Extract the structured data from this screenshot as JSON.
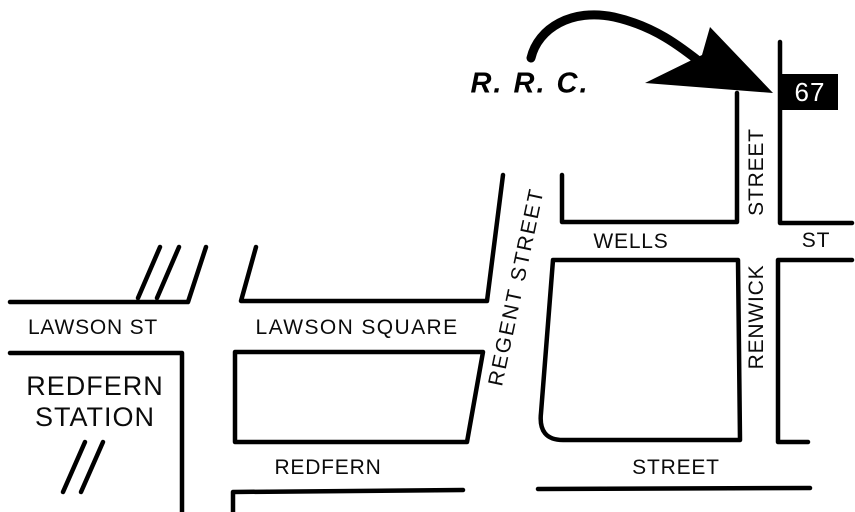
{
  "map": {
    "background": "#ffffff",
    "ink": "#000000",
    "marker": {
      "label": "67",
      "bg": "#000000",
      "text_color": "#ffffff"
    },
    "annotation": {
      "label": "R. R. C."
    },
    "streets": {
      "lawson_st": "LAWSON ST",
      "lawson_square": "LAWSON SQUARE",
      "wells": "WELLS",
      "wells_abbrev": "ST",
      "regent": "REGENT STREET",
      "renwick": "RENWICK",
      "renwick_suffix": "STREET",
      "redfern": "REDFERN",
      "redfern_suffix": "STREET"
    },
    "places": {
      "station_line1": "REDFERN",
      "station_line2": "STATION"
    }
  }
}
